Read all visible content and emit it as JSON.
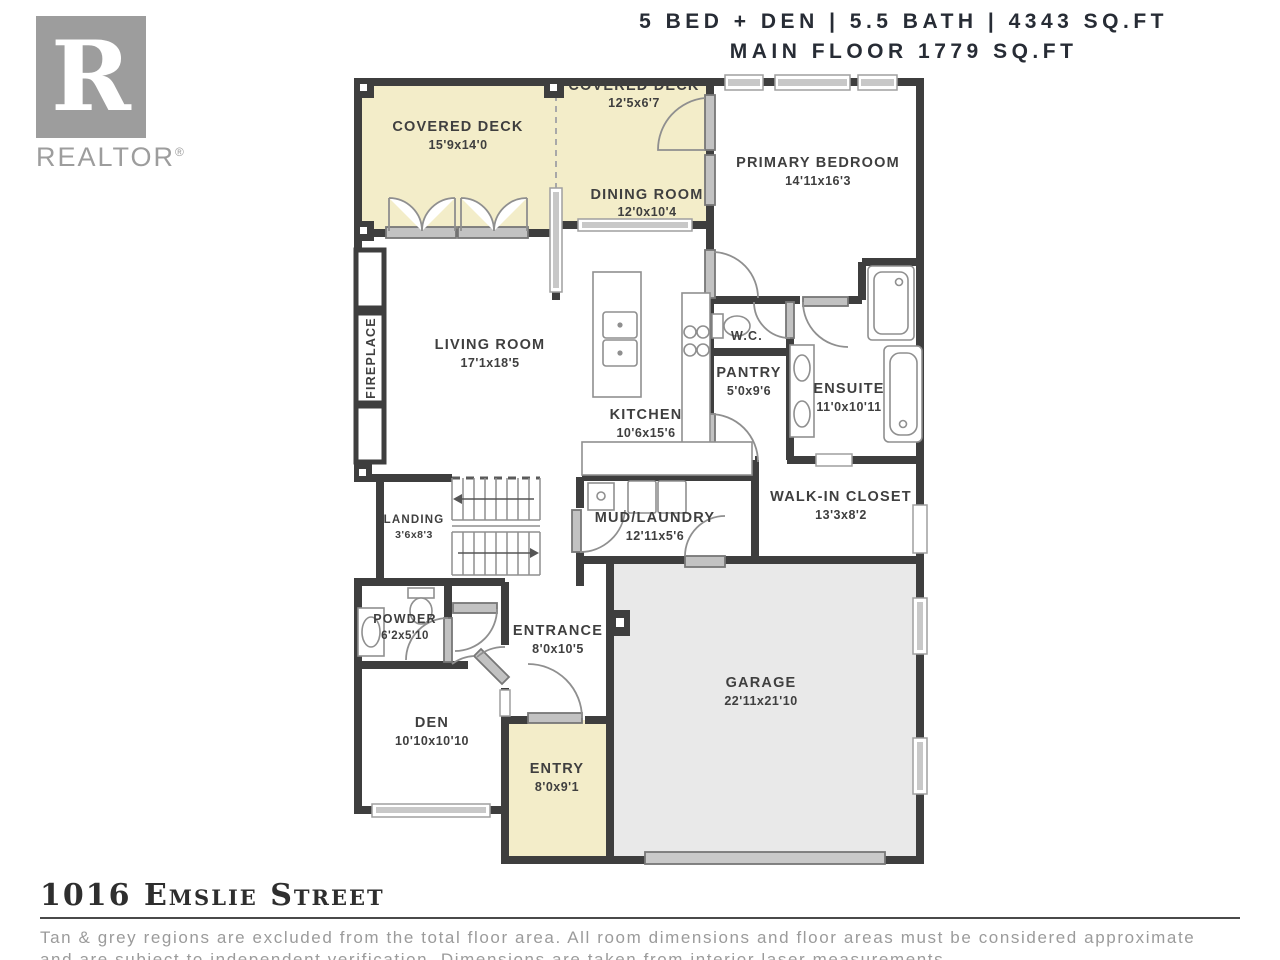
{
  "header": {
    "line1": "5 BED + DEN | 5.5 BATH | 4343 SQ.FT",
    "line2": "MAIN FLOOR 1779 SQ.FT"
  },
  "logo": {
    "letter": "R",
    "word": "REALTOR",
    "reg": "®"
  },
  "rooms": {
    "covered_deck_left": {
      "name": "COVERED DECK",
      "dims": "15'9x14'0"
    },
    "covered_deck_top": {
      "name": "COVERED DECK",
      "dims": "12'5x6'7"
    },
    "dining": {
      "name": "DINING ROOM",
      "dims": "12'0x10'4"
    },
    "primary": {
      "name": "PRIMARY BEDROOM",
      "dims": "14'11x16'3"
    },
    "living": {
      "name": "LIVING ROOM",
      "dims": "17'1x18'5"
    },
    "kitchen": {
      "name": "KITCHEN",
      "dims": "10'6x15'6"
    },
    "wc": {
      "name": "W.C."
    },
    "pantry": {
      "name": "PANTRY",
      "dims": "5'0x9'6"
    },
    "ensuite": {
      "name": "ENSUITE",
      "dims": "11'0x10'11"
    },
    "walkin": {
      "name": "WALK-IN CLOSET",
      "dims": "13'3x8'2"
    },
    "mud": {
      "name": "MUD/LAUNDRY",
      "dims": "12'11x5'6"
    },
    "landing": {
      "name": "LANDING",
      "dims": "3'6x8'3"
    },
    "powder": {
      "name": "POWDER",
      "dims": "6'2x5'10"
    },
    "entrance": {
      "name": "ENTRANCE",
      "dims": "8'0x10'5"
    },
    "den": {
      "name": "DEN",
      "dims": "10'10x10'10"
    },
    "entry": {
      "name": "ENTRY",
      "dims": "8'0x9'1"
    },
    "garage": {
      "name": "GARAGE",
      "dims": "22'11x21'10"
    },
    "fireplace": {
      "name": "FIREPLACE"
    }
  },
  "footer": {
    "address": "1016 Emslie Street",
    "disclaimer_line1": "Tan & grey regions are excluded from the total floor area. All room dimensions and floor areas must be considered approximate",
    "disclaimer_line2": "and are subject to independent verification. Dimensions are taken from interior laser measurements."
  },
  "colors": {
    "wall": "#3e3e3e",
    "deck_fill": "#f3edc9",
    "garage_fill": "#e9e9e9",
    "door_grey": "#c2c2c2",
    "logo_grey": "#9d9d9d",
    "header_text": "#272c35",
    "label_text": "#3f3f3f",
    "disclaimer_text": "#9b9b9b"
  }
}
